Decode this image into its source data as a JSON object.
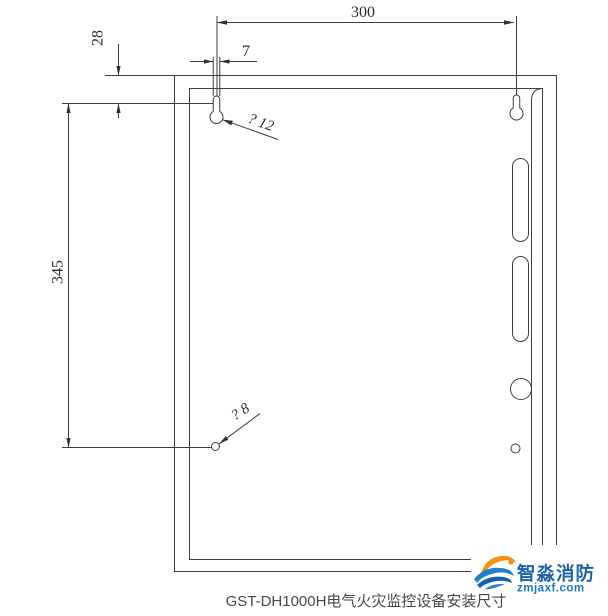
{
  "drawing": {
    "title_caption": "GST-DH1000H电气火灾监控设备安装尺寸",
    "dimensions": {
      "top_width": "300",
      "top_edge_to_hole": "28",
      "keyhole_slot_width": "7",
      "hole_vertical_spacing": "345"
    },
    "labels": {
      "keyhole_diameter": "? 12",
      "bottom_hole_diameter": "? 8"
    }
  },
  "watermark": {
    "brand": "智淼消防",
    "site": "zmjaxf.com"
  },
  "colors": {
    "line": "#3d3d42",
    "dim_text": "#2e2e33",
    "caption": "#47474c",
    "logo_blue": "#1c63ad",
    "logo_site_blue": "#1878c8",
    "logo_orange": "#f39110",
    "background": "#ffffff"
  }
}
